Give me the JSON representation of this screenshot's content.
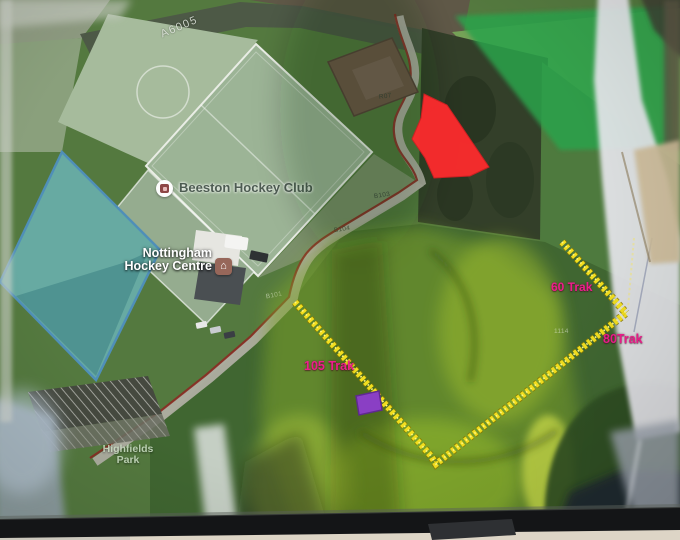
{
  "map": {
    "road_label": "A6005",
    "pois": [
      {
        "label": "Beeston Hockey Club",
        "icon": "hockey-club-marker-icon"
      },
      {
        "line1": "Nottingham",
        "line2": "Hockey Centre",
        "icon": "building-marker-icon"
      },
      {
        "line1": "Highfields",
        "line2": "Park"
      }
    ],
    "parcels": {
      "r101": "R101",
      "r07": "R07",
      "b103": "B103",
      "b104": "B104",
      "b101": "B101",
      "n1114": "1114"
    }
  },
  "annotations": {
    "track_60": "60 Trak",
    "track_80": "80Trak",
    "track_105": "105 Trak",
    "colors": {
      "track_line": "#f2de1e",
      "track_label": "#ee1d8c",
      "zone_red": "#fd2b2d",
      "marker_purple": "#8a3fc4"
    }
  }
}
